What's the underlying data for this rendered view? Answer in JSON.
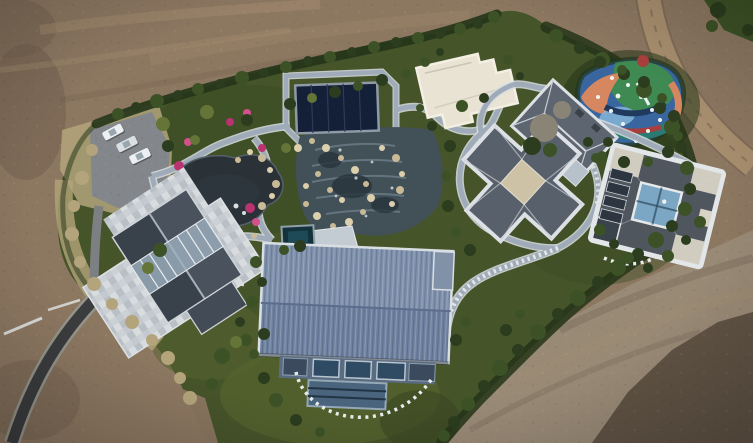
{
  "scene": {
    "type": "aerial-photograph",
    "subject": "drone top-down view of a private landscaped estate compound surrounded by bare graded earth",
    "features": [
      {
        "name": "dirt-terrain",
        "label": "bare brown earth surrounding the estate"
      },
      {
        "name": "dirt-road-top-right",
        "label": "unpaved track curving along the upper-right"
      },
      {
        "name": "access-road",
        "label": "dark asphalt drive entering from lower-left"
      },
      {
        "name": "parking-area",
        "label": "small parking pad with three light cars"
      },
      {
        "name": "ornamental-pond",
        "label": "dark garden pond ringed by magenta flower beds and rocks"
      },
      {
        "name": "water-cascade-garden",
        "label": "terraced rock-and-water feature"
      },
      {
        "name": "pool-pavilion",
        "label": "dark navy covered pool structure"
      },
      {
        "name": "left-house",
        "label": "gabled slate-roof house with skylights and mosaic stone terrace"
      },
      {
        "name": "barn-building",
        "label": "large blue standing-seam gable roof building with glass front"
      },
      {
        "name": "white-flat-roof-building",
        "label": "cream flat-roofed outbuilding"
      },
      {
        "name": "hip-roof-villa",
        "label": "cross-plan villa with grey hip roofs and white trim"
      },
      {
        "name": "courtyard-villa",
        "label": "square villa with central glass courtyard"
      },
      {
        "name": "playground",
        "label": "colorful rubber-surface playground with white equipment"
      },
      {
        "name": "stone-paths",
        "label": "winding blue-grey stone paths with pale edging"
      },
      {
        "name": "hedge-border",
        "label": "dense dark-green shrub belt around the estate"
      },
      {
        "name": "lawn",
        "label": "olive-green lawns around the lower buildings"
      }
    ]
  },
  "colors": {
    "dirtBase": "#8c7761",
    "dirtLight": "#a68e70",
    "dirtDark": "#6d5b4b",
    "dirtShadow": "#51453a",
    "dirtGray": "#9b8d7a",
    "dirtRoadTR": "#a78e6e",
    "lawn": "#46542a",
    "lawnLight": "#55642f",
    "lawnDark": "#35421f",
    "hedge": "#243418",
    "treeDark": "#2b3d1e",
    "treeMid": "#3c5226",
    "oliveShrub": "#657537",
    "bareTree": "#8a8476",
    "weed": "#b3a47b",
    "gardenDark": "#3a4c24",
    "pathCase": "#d8dde2",
    "pathCore": "#9fabb8",
    "asphalt": "#3a3c3d",
    "roadEdge": "#96978f",
    "wall": "#d9dad6",
    "pond": "#2a3137",
    "pondHi": "#3c464e",
    "cascade": "#425058",
    "cascadeStep": "#70808c",
    "cascadePool": "#27333c",
    "foam": "#cfd9dd",
    "navy": "#141f38",
    "navyFrame": "#8f9aa6",
    "navyLine": "#2e3b58",
    "spa": "#14323c",
    "spaHi": "#1d4a56",
    "deck": "#c3ccd2",
    "whiteRoof": "#e9e3d3",
    "whiteRoofEdge": "#f3efe3",
    "terraceA": "#ccd1d5",
    "terraceB": "#c3c9ce",
    "terraceC": "#d8dcdf",
    "terraceD": "#b8bfc5",
    "slate1": "#39414b",
    "slate2": "#4a525e",
    "skylight": "#9db0bf",
    "ridge": "#a7b1ba",
    "trim": "#dde1e5",
    "hipLine": "#c8cdd2",
    "villaRoofA": "#5d6670",
    "villaRoofB": "#57606b",
    "villaFlat": "#cdc2a6",
    "villaGlass": "#b7c1c9",
    "chimney": "#3a4149",
    "villa2Roof": "#4f565e",
    "villa2Court": "#7ba6c4",
    "villa2CourtDark": "#2e4b60",
    "villa2Flat": "#d8d3c5",
    "villa2DarkWing": "#3a424c",
    "villaSlat": "#2c3540",
    "barnRoofA": "#7e90ac",
    "barnRoofB": "#6e81a0",
    "barnAnnex": "#8191a8",
    "barnTrim": "#d9dee3",
    "barnShadow": "#2c3440",
    "barnFacade": "#5a6c82",
    "barnWin": "#2f4a63",
    "barnWinFrame": "#b8c4ce",
    "barnSlat": "#3b4a5c",
    "barnGlass": "#4a647e",
    "barnGlassFrame": "#95a8b8",
    "barnGlassLine": "#223344",
    "stepStone": "#e9ecec",
    "rock": "#c9ba97",
    "rockLight": "#dccfae",
    "flowerA": "#b8336f",
    "flowerB": "#d2508c",
    "playBase": "#3a66a0",
    "playGreen": "#3f8a52",
    "playTeal": "#2b7a74",
    "playOrange": "#d6875f",
    "playRed": "#a83f3c",
    "playLightBlue": "#7fb0d6",
    "playNavy": "#1f3a5c",
    "white": "#eef1f2",
    "carWhite": "#ecf0f2",
    "carSilver": "#d9dfe3",
    "carGlass": "#9aa6ad",
    "carShadow": "#2e2f30"
  },
  "shrub_tones": [
    "treeDark",
    "treeMid",
    "oliveShrub",
    "bareTree",
    "weed",
    "hedge"
  ],
  "shrubs": [
    [
      118,
      114,
      6,
      1
    ],
    [
      136,
      107,
      5,
      0
    ],
    [
      157,
      101,
      7,
      1
    ],
    [
      178,
      95,
      5,
      0
    ],
    [
      198,
      89,
      6,
      1
    ],
    [
      220,
      84,
      5,
      0
    ],
    [
      242,
      78,
      7,
      1
    ],
    [
      264,
      73,
      5,
      0
    ],
    [
      286,
      67,
      6,
      1
    ],
    [
      308,
      61,
      5,
      0
    ],
    [
      330,
      57,
      6,
      1
    ],
    [
      352,
      52,
      5,
      0
    ],
    [
      374,
      47,
      6,
      1
    ],
    [
      396,
      42,
      5,
      0
    ],
    [
      418,
      38,
      6,
      1
    ],
    [
      440,
      34,
      5,
      0
    ],
    [
      460,
      29,
      6,
      1
    ],
    [
      478,
      24,
      5,
      0
    ],
    [
      494,
      17,
      6,
      1
    ],
    [
      556,
      36,
      7,
      1
    ],
    [
      580,
      48,
      6,
      0
    ],
    [
      602,
      60,
      8,
      1
    ],
    [
      624,
      74,
      6,
      0
    ],
    [
      644,
      90,
      8,
      1
    ],
    [
      660,
      108,
      6,
      0
    ],
    [
      672,
      127,
      8,
      1
    ],
    [
      681,
      147,
      6,
      0
    ],
    [
      687,
      168,
      7,
      1
    ],
    [
      690,
      189,
      6,
      0
    ],
    [
      685,
      209,
      7,
      1
    ],
    [
      672,
      226,
      6,
      0
    ],
    [
      656,
      240,
      8,
      1
    ],
    [
      638,
      254,
      6,
      0
    ],
    [
      618,
      268,
      8,
      1
    ],
    [
      598,
      282,
      6,
      0
    ],
    [
      578,
      298,
      8,
      1
    ],
    [
      558,
      314,
      6,
      0
    ],
    [
      538,
      332,
      8,
      1
    ],
    [
      518,
      350,
      6,
      0
    ],
    [
      500,
      368,
      8,
      1
    ],
    [
      484,
      386,
      6,
      0
    ],
    [
      468,
      404,
      7,
      1
    ],
    [
      454,
      422,
      6,
      0
    ],
    [
      444,
      436,
      6,
      1
    ],
    [
      163,
      124,
      7,
      2
    ],
    [
      186,
      117,
      6,
      1
    ],
    [
      207,
      112,
      7,
      2
    ],
    [
      228,
      106,
      5,
      1
    ],
    [
      168,
      146,
      6,
      0
    ],
    [
      195,
      140,
      5,
      2
    ],
    [
      247,
      120,
      6,
      0
    ],
    [
      268,
      112,
      5,
      1
    ],
    [
      290,
      104,
      6,
      0
    ],
    [
      312,
      98,
      5,
      2
    ],
    [
      335,
      92,
      6,
      0
    ],
    [
      358,
      86,
      5,
      1
    ],
    [
      382,
      80,
      6,
      0
    ],
    [
      406,
      74,
      5,
      1
    ],
    [
      160,
      250,
      7,
      1
    ],
    [
      148,
      268,
      6,
      2
    ],
    [
      286,
      148,
      5,
      2
    ],
    [
      300,
      246,
      6,
      0
    ],
    [
      284,
      250,
      5,
      1
    ],
    [
      256,
      262,
      6,
      1
    ],
    [
      262,
      282,
      5,
      0
    ],
    [
      252,
      302,
      6,
      1
    ],
    [
      240,
      322,
      5,
      0
    ],
    [
      246,
      340,
      6,
      1
    ],
    [
      92,
      150,
      6,
      4
    ],
    [
      82,
      178,
      7,
      4
    ],
    [
      74,
      206,
      6,
      4
    ],
    [
      72,
      234,
      7,
      4
    ],
    [
      80,
      262,
      6,
      4
    ],
    [
      94,
      284,
      7,
      4
    ],
    [
      112,
      304,
      6,
      4
    ],
    [
      132,
      322,
      7,
      4
    ],
    [
      152,
      340,
      6,
      4
    ],
    [
      168,
      358,
      7,
      4
    ],
    [
      180,
      378,
      6,
      4
    ],
    [
      190,
      398,
      7,
      4
    ],
    [
      264,
      334,
      6,
      0
    ],
    [
      254,
      354,
      5,
      1
    ],
    [
      264,
      378,
      6,
      0
    ],
    [
      276,
      400,
      7,
      1
    ],
    [
      296,
      420,
      6,
      0
    ],
    [
      320,
      432,
      5,
      1
    ],
    [
      222,
      356,
      8,
      1
    ],
    [
      236,
      342,
      6,
      2
    ],
    [
      212,
      384,
      6,
      1
    ],
    [
      456,
      340,
      6,
      0
    ],
    [
      466,
      322,
      5,
      1
    ],
    [
      506,
      330,
      6,
      0
    ],
    [
      520,
      314,
      5,
      1
    ],
    [
      462,
      106,
      6,
      1
    ],
    [
      484,
      98,
      5,
      0
    ],
    [
      450,
      146,
      6,
      0
    ],
    [
      446,
      176,
      5,
      1
    ],
    [
      448,
      206,
      6,
      0
    ],
    [
      456,
      232,
      5,
      1
    ],
    [
      470,
      250,
      6,
      0
    ],
    [
      600,
      230,
      6,
      1
    ],
    [
      614,
      244,
      5,
      0
    ],
    [
      628,
      258,
      6,
      1
    ],
    [
      648,
      268,
      5,
      0
    ],
    [
      668,
      256,
      6,
      1
    ],
    [
      686,
      240,
      5,
      0
    ],
    [
      700,
      222,
      6,
      1
    ],
    [
      608,
      142,
      5,
      0
    ],
    [
      596,
      158,
      5,
      1
    ],
    [
      600,
      62,
      6,
      0
    ],
    [
      622,
      70,
      5,
      1
    ],
    [
      644,
      82,
      6,
      0
    ],
    [
      662,
      98,
      5,
      1
    ],
    [
      674,
      116,
      6,
      0
    ],
    [
      678,
      136,
      5,
      1
    ],
    [
      668,
      152,
      6,
      0
    ],
    [
      648,
      162,
      5,
      1
    ],
    [
      624,
      162,
      6,
      0
    ],
    [
      602,
      156,
      5,
      1
    ],
    [
      588,
      142,
      5,
      0
    ],
    [
      544,
      128,
      14,
      3
    ],
    [
      562,
      110,
      9,
      3
    ],
    [
      532,
      146,
      9,
      0
    ],
    [
      550,
      150,
      7,
      1
    ],
    [
      718,
      10,
      8,
      0
    ],
    [
      736,
      18,
      7,
      1
    ],
    [
      748,
      30,
      6,
      0
    ],
    [
      712,
      26,
      6,
      1
    ],
    [
      425,
      62,
      5,
      1
    ],
    [
      440,
      52,
      4,
      0
    ],
    [
      508,
      60,
      5,
      1
    ],
    [
      520,
      76,
      4,
      0
    ],
    [
      432,
      126,
      5,
      0
    ],
    [
      420,
      108,
      4,
      1
    ]
  ],
  "rocks": [
    [
      262,
      158,
      4
    ],
    [
      270,
      170,
      3
    ],
    [
      276,
      184,
      4
    ],
    [
      272,
      196,
      3
    ],
    [
      262,
      206,
      4
    ],
    [
      298,
      148,
      4
    ],
    [
      312,
      141,
      3
    ],
    [
      326,
      148,
      4
    ],
    [
      341,
      158,
      3
    ],
    [
      355,
      170,
      4
    ],
    [
      366,
      184,
      3
    ],
    [
      371,
      198,
      4
    ],
    [
      363,
      212,
      3
    ],
    [
      349,
      222,
      4
    ],
    [
      333,
      226,
      3
    ],
    [
      317,
      216,
      4
    ],
    [
      306,
      204,
      3
    ],
    [
      382,
      148,
      3
    ],
    [
      396,
      158,
      4
    ],
    [
      402,
      174,
      3
    ],
    [
      400,
      190,
      4
    ],
    [
      392,
      204,
      3
    ],
    [
      330,
      190,
      3
    ],
    [
      342,
      200,
      3
    ],
    [
      318,
      174,
      3
    ],
    [
      306,
      186,
      3
    ],
    [
      238,
      160,
      3
    ],
    [
      250,
      152,
      3
    ],
    [
      226,
      226,
      3
    ],
    [
      240,
      232,
      3
    ],
    [
      254,
      236,
      3
    ]
  ],
  "flower_beds": [
    [
      179,
      166,
      5
    ],
    [
      172,
      181,
      4
    ],
    [
      175,
      196,
      5
    ],
    [
      184,
      211,
      4
    ],
    [
      196,
      222,
      5
    ],
    [
      212,
      229,
      4
    ],
    [
      230,
      122,
      4
    ],
    [
      247,
      113,
      4
    ],
    [
      250,
      208,
      5
    ],
    [
      256,
      222,
      4
    ],
    [
      262,
      148,
      4
    ],
    [
      188,
      142,
      4
    ],
    [
      160,
      232,
      4
    ]
  ],
  "play_equipment": [
    [
      612,
      78,
      2
    ],
    [
      628,
      85,
      2
    ],
    [
      641,
      97,
      2
    ],
    [
      652,
      110,
      2
    ],
    [
      598,
      97,
      2
    ],
    [
      611,
      111,
      2
    ],
    [
      623,
      124,
      2
    ],
    [
      648,
      131,
      2
    ],
    [
      660,
      120,
      2
    ],
    [
      636,
      141,
      2
    ],
    [
      594,
      130,
      2
    ],
    [
      618,
      96,
      2.4
    ]
  ],
  "cars": [
    {
      "x": 113,
      "y": 132,
      "angle": -28,
      "tone": "carWhite"
    },
    {
      "x": 127,
      "y": 144,
      "angle": -27,
      "tone": "carSilver"
    },
    {
      "x": 140,
      "y": 156,
      "angle": -26,
      "tone": "carWhite"
    }
  ]
}
